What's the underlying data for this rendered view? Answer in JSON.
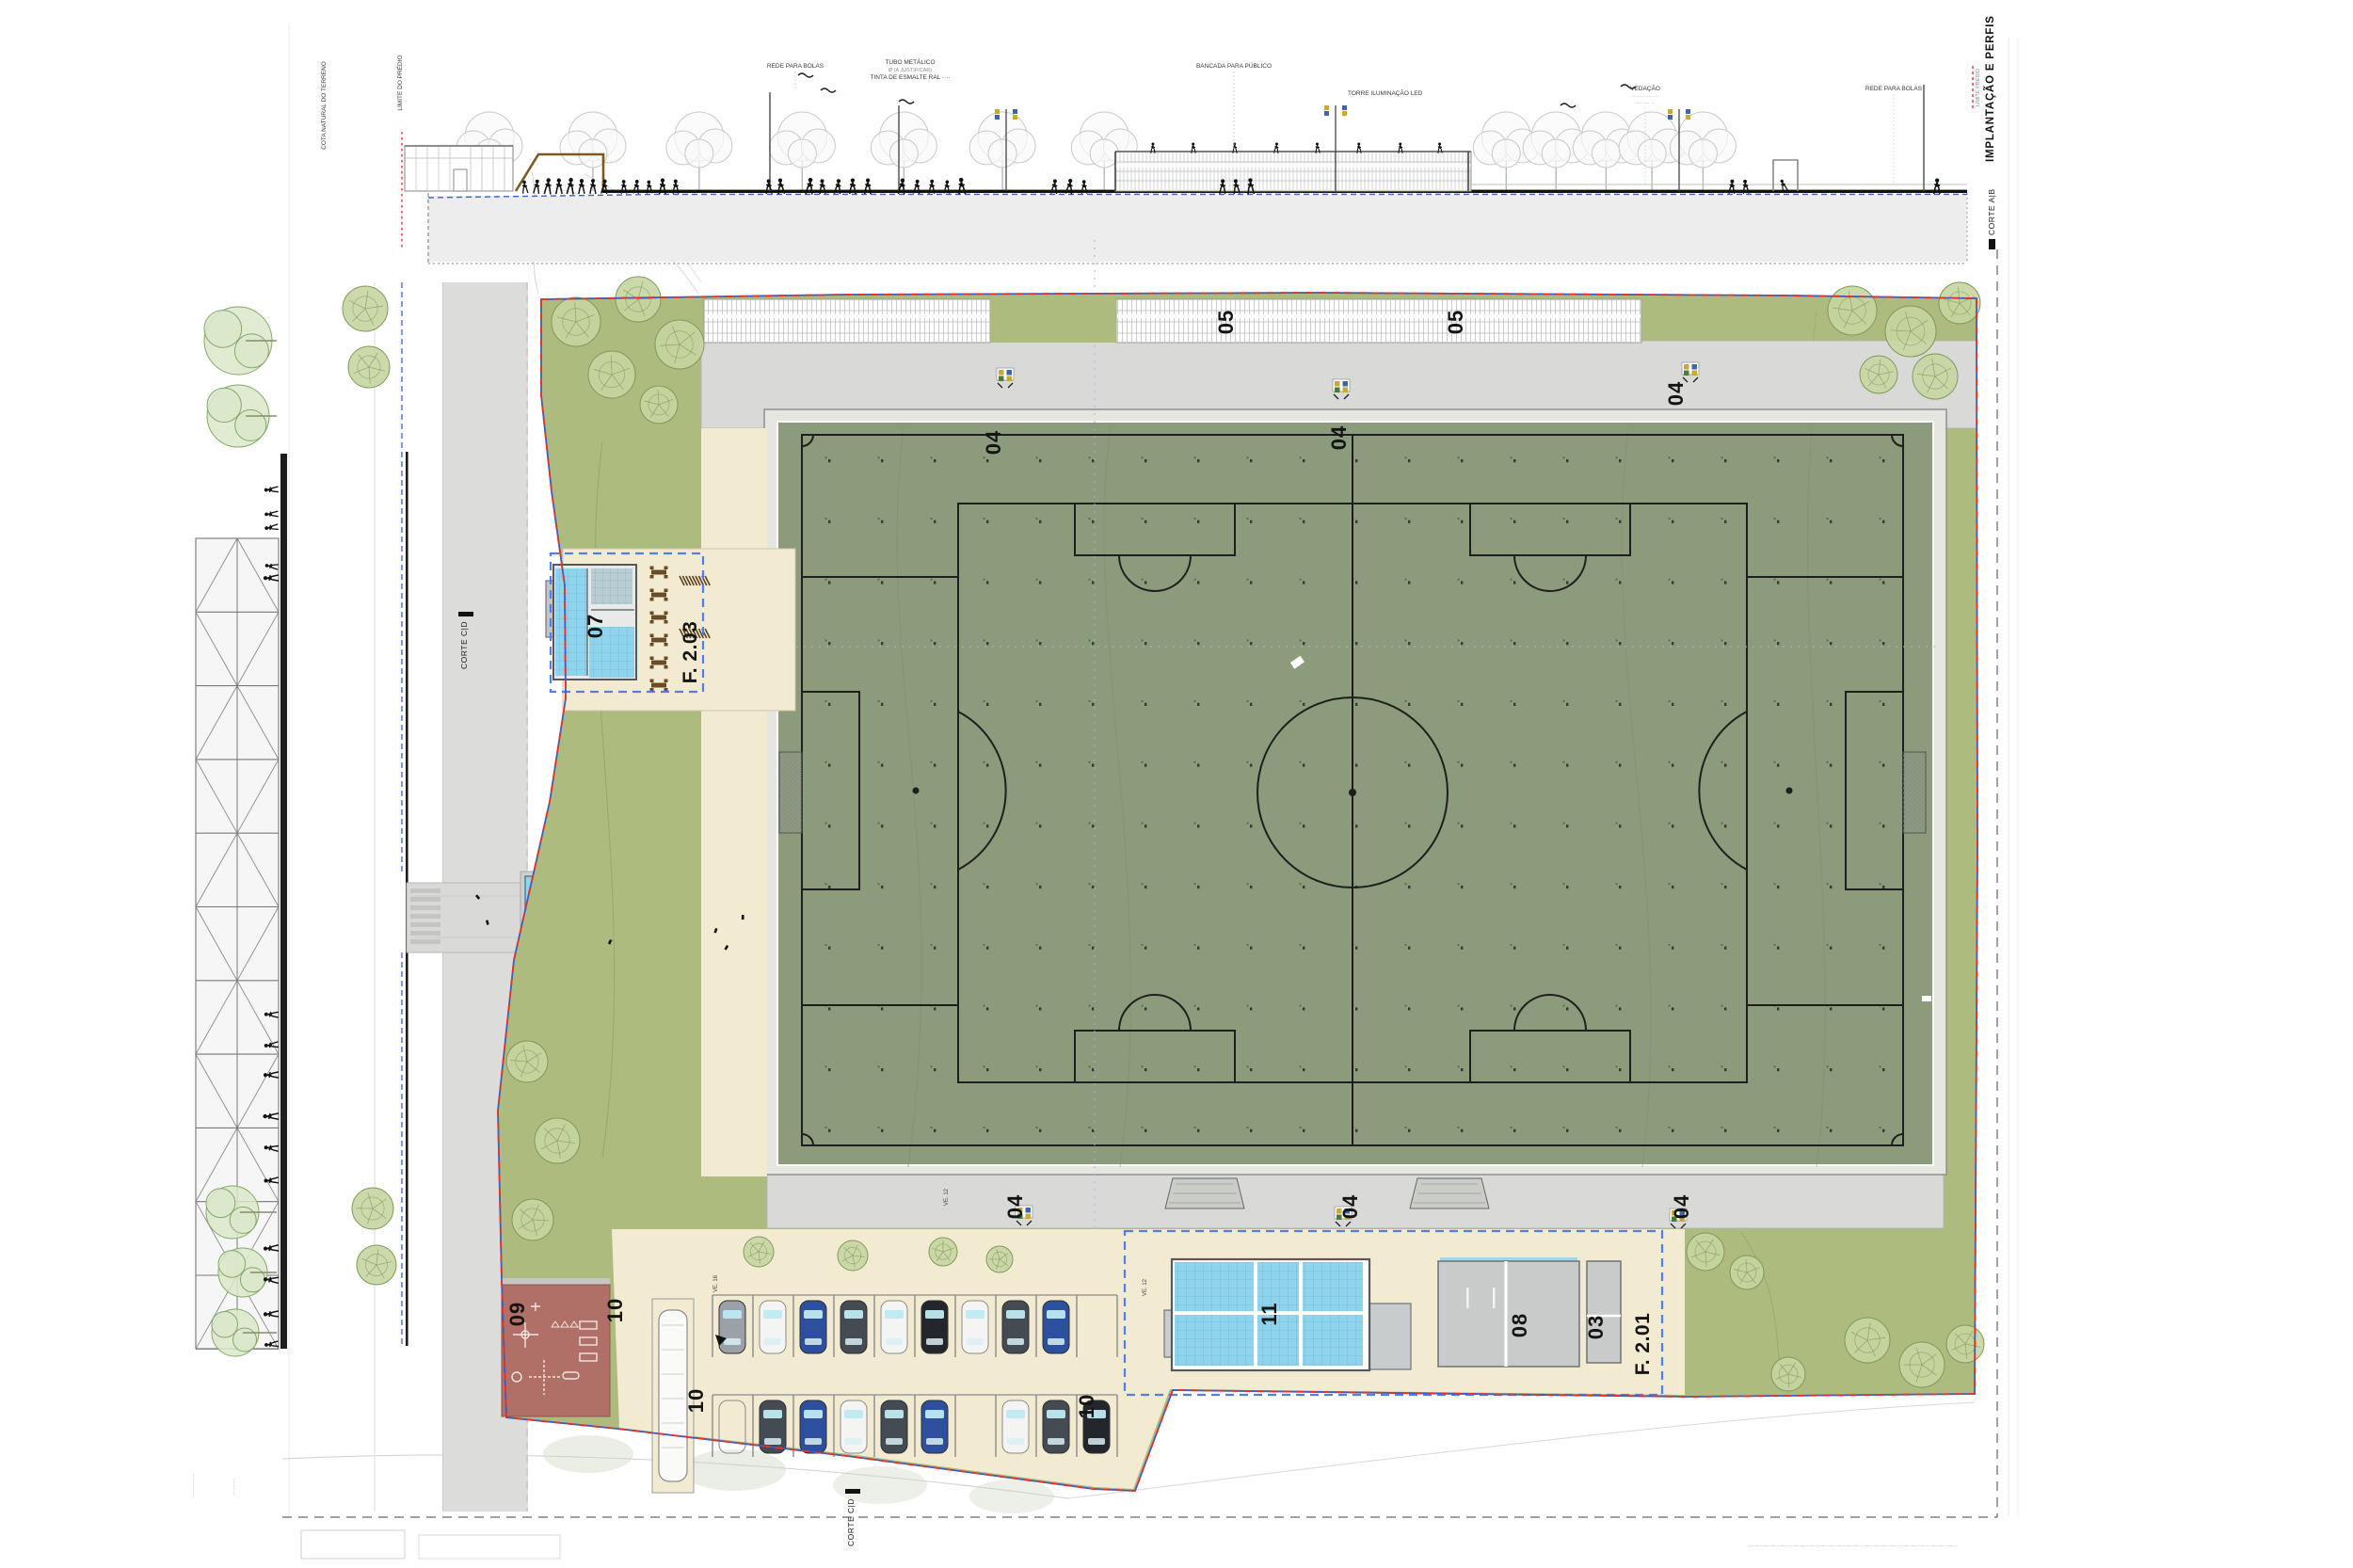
{
  "title": {
    "sheet_title": "IMPLANTAÇÃO E PERFIS",
    "section_right": "CORTE A|B",
    "section_left": "CORTE C|D",
    "section_bottom": "CORTE C|D",
    "legend_boundary": "LIMITE PRÉDIO"
  },
  "elevation": {
    "cota": "COTA NATURAL DO TERRENO",
    "limite": "LIMITE DO PRÉDIO",
    "rede_bolas": "REDE PARA BOLAS",
    "tubo1": "TUBO METÁLICO",
    "tubo2": "Ø (A JUSTIFICAR)",
    "tubo3": "TINTA DE ESMALTE RAL ····",
    "bancada": "BANCADA PARA PÚBLICO",
    "torre": "TORRE ILUMINAÇÃO LED",
    "vedacao": "VEDAÇÃO",
    "vedacao_sub1": "·· ····· ···· ··",
    "vedacao_sub2": "··· ···· ··"
  },
  "plan_labels": {
    "n03": "03",
    "n04": "04",
    "n05": "05",
    "n07": "07",
    "n08": "08",
    "n09": "09",
    "n10": "10",
    "n11": "11",
    "f201": "F. 2.01",
    "f203": "F. 2.03",
    "ve12": "VE. 12",
    "ve16": "VE. 16"
  },
  "margins": {
    "fine_print": "···–···–··–····–···–··–·····–···–··–···–····–··–···–···–··–····–···–··–·····–···–··–···–····",
    "corner_tiny_a": "··············",
    "corner_tiny_b": "··········"
  },
  "colors": {
    "terrain_green": "#adbb7f",
    "pitch_green": "#8b9b7b",
    "beige": "#f2ebd2",
    "walk_gray": "#d9d9d7",
    "playground_red": "#b06f67",
    "room_cyan": "#8fd4ec",
    "boundary_red": "#e63329",
    "boundary_blue": "#2f5fd2",
    "selection_blue": "#4f7fe8"
  }
}
